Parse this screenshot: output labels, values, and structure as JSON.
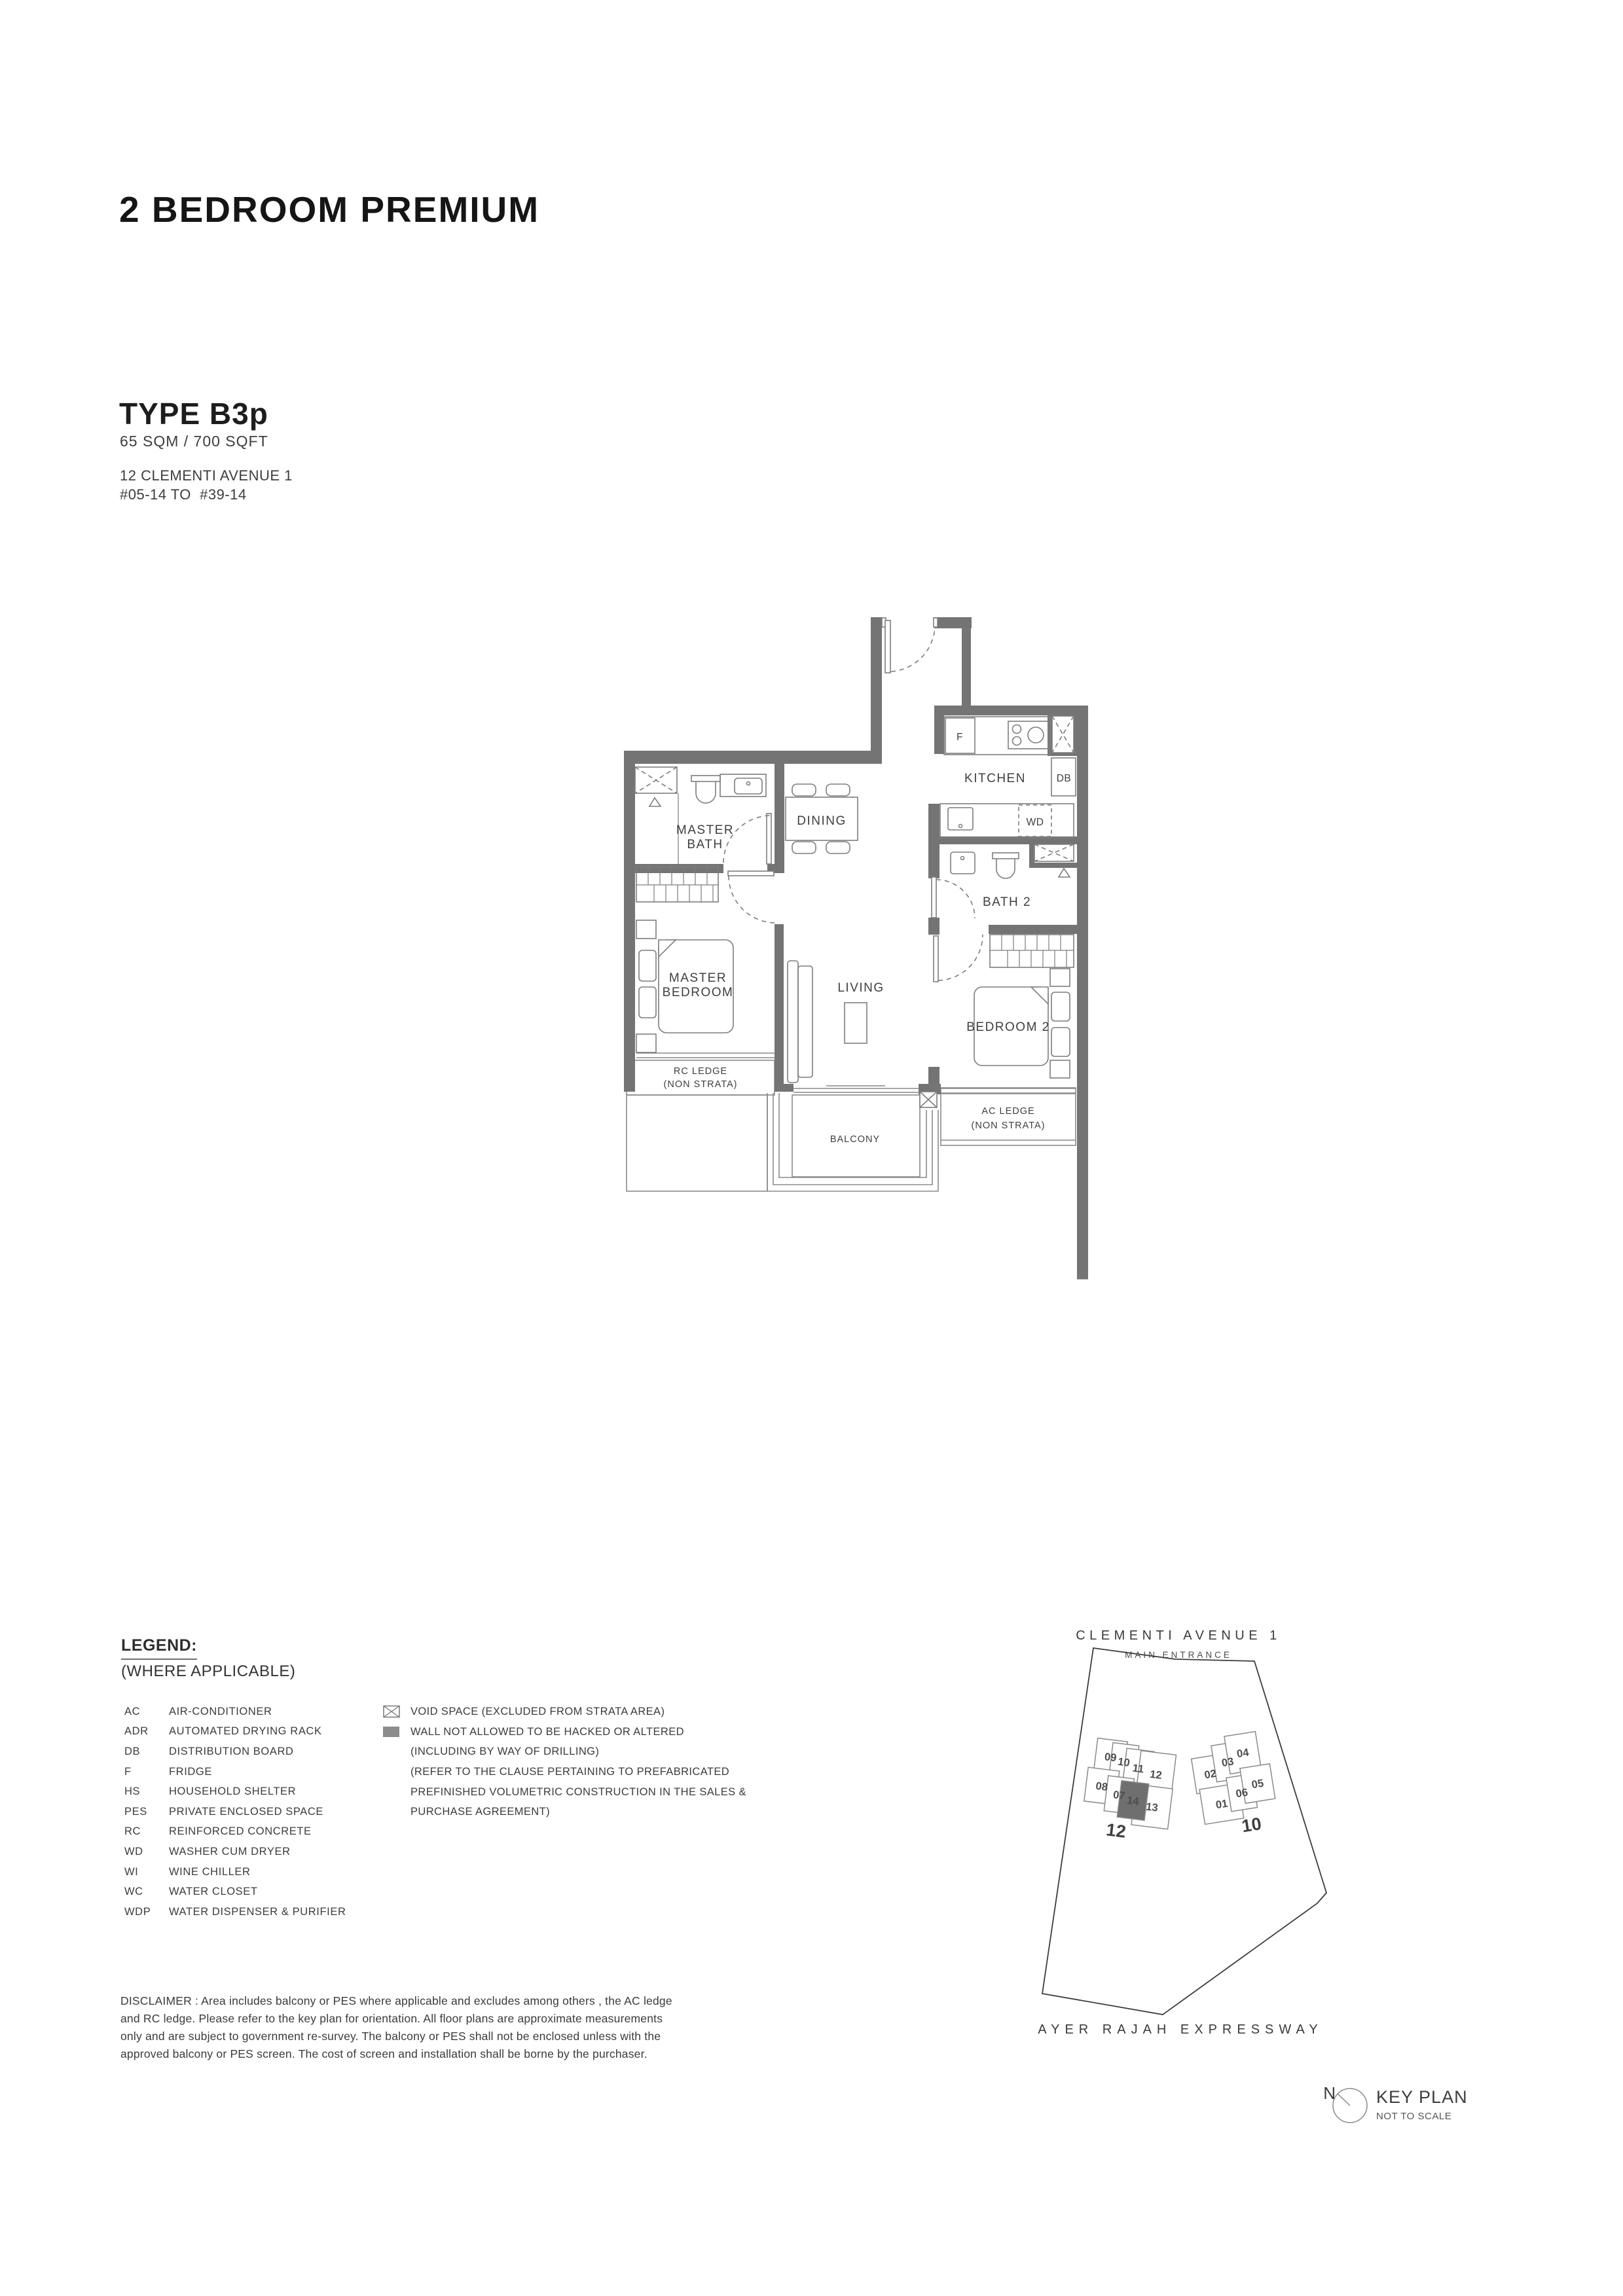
{
  "header": {
    "title": "2 BEDROOM PREMIUM",
    "type": "TYPE B3p",
    "area": "65 SQM / 700 SQFT",
    "address1": "12 CLEMENTI AVENUE 1",
    "address2": "#05-14 TO  #39-14"
  },
  "plan": {
    "labels": {
      "kitchen": "KITCHEN",
      "dining": "DINING",
      "living": "LIVING",
      "bath2": "BATH 2",
      "bedroom2": "BEDROOM 2",
      "balcony": "BALCONY",
      "fridge": "F",
      "washer_dryer": "WD",
      "distribution_board": "DB",
      "master_bath": [
        "MASTER",
        "BATH"
      ],
      "master_bedroom": [
        "MASTER",
        "BEDROOM"
      ],
      "rc_ledge": [
        "RC LEDGE",
        "(NON STRATA)"
      ],
      "ac_ledge": [
        "AC LEDGE",
        "(NON STRATA)"
      ]
    }
  },
  "legend": {
    "heading": "LEGEND:",
    "subheading": "(WHERE APPLICABLE)",
    "items": [
      {
        "abbr": "AC",
        "label": "AIR-CONDITIONER"
      },
      {
        "abbr": "ADR",
        "label": "AUTOMATED DRYING RACK"
      },
      {
        "abbr": "DB",
        "label": "DISTRIBUTION BOARD"
      },
      {
        "abbr": "F",
        "label": "FRIDGE"
      },
      {
        "abbr": "HS",
        "label": "HOUSEHOLD SHELTER"
      },
      {
        "abbr": "PES",
        "label": "PRIVATE ENCLOSED SPACE"
      },
      {
        "abbr": "RC",
        "label": "REINFORCED CONCRETE"
      },
      {
        "abbr": "WD",
        "label": "WASHER CUM DRYER"
      },
      {
        "abbr": "WI",
        "label": "WINE CHILLER"
      },
      {
        "abbr": "WC",
        "label": "WATER CLOSET"
      },
      {
        "abbr": "WDP",
        "label": "WATER DISPENSER & PURIFIER"
      }
    ],
    "symbols": {
      "void_label": "VOID SPACE (EXCLUDED FROM STRATA AREA)",
      "wall_line1": "WALL NOT ALLOWED TO BE HACKED OR ALTERED",
      "wall_line2": "(INCLUDING BY WAY OF DRILLING)",
      "wall_line3": "(REFER TO THE CLAUSE PERTAINING TO PREFABRICATED",
      "wall_line4": "PREFINISHED VOLUMETRIC CONSTRUCTION IN THE SALES &",
      "wall_line5": "PURCHASE AGREEMENT)"
    }
  },
  "disclaimer": {
    "line1": "DISCLAIMER : Area includes balcony or PES where applicable and excludes among others , the AC ledge",
    "line2": "and RC ledge. Please refer to the key plan for orientation. All floor plans are approximate measurements",
    "line3": "only and are subject to government re-survey. The balcony or PES shall not be enclosed unless with the",
    "line4": "approved balcony or PES screen. The cost of screen and installation shall be borne by the purchaser."
  },
  "keyplan": {
    "road_top": "CLEMENTI AVENUE 1",
    "main_entrance": "MAIN ENTRANCE",
    "road_bottom": "AYER RAJAH EXPRESSWAY",
    "left_block": {
      "label": "12",
      "units": [
        "09",
        "10",
        "11",
        "12",
        "08",
        "07",
        "14",
        "13"
      ],
      "highlighted_unit": "14"
    },
    "right_block": {
      "label": "10",
      "units": [
        "02",
        "03",
        "04",
        "01",
        "06",
        "05"
      ]
    },
    "north": "N",
    "title": "KEY PLAN",
    "subtitle": "NOT TO SCALE"
  },
  "colors": {
    "wall": "#747474",
    "thin_line": "#8a8a8a",
    "label_text": "#3f3f3f",
    "highlight_unit": "#6f6f6f"
  }
}
